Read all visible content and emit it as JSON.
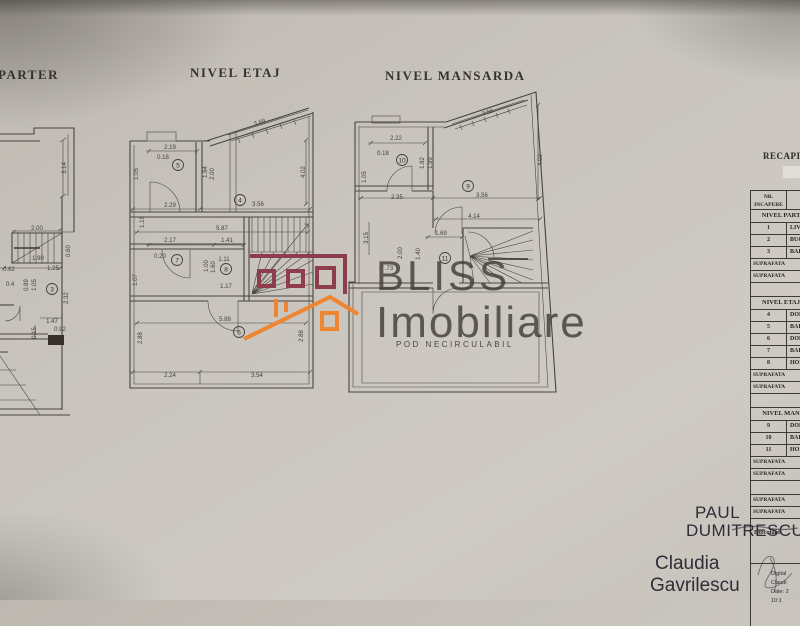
{
  "titles": {
    "parter": "PARTER",
    "etaj": "NIVEL ETAJ",
    "mansarda": "NIVEL MANSARDA"
  },
  "watermark": {
    "line1": "BLISS",
    "line2": "Imobiliare",
    "maroon_color": "#8e3d4d",
    "orange_color": "#ee8531"
  },
  "plans": {
    "parter": {
      "rooms": [
        {
          "n": "3",
          "x": 52,
          "y": 289
        }
      ],
      "dims": [
        {
          "t": "3.14",
          "x": 66,
          "y": 168,
          "r": -90
        },
        {
          "t": "2.00",
          "x": 37,
          "y": 230
        },
        {
          "t": "1.90",
          "x": 38,
          "y": 260
        },
        {
          "t": "0.60",
          "x": 70,
          "y": 251,
          "r": -90
        },
        {
          "t": "0.62",
          "x": 9,
          "y": 271
        },
        {
          "t": "1.25",
          "x": 53,
          "y": 270
        },
        {
          "t": "0.89",
          "x": 28,
          "y": 285,
          "r": -90
        },
        {
          "t": "1.05",
          "x": 36,
          "y": 285,
          "r": -90
        },
        {
          "t": "0.4",
          "x": 10,
          "y": 286
        },
        {
          "t": "2.32",
          "x": 68,
          "y": 298,
          "r": -90
        },
        {
          "t": "1.47",
          "x": 52,
          "y": 323
        },
        {
          "t": "0.92",
          "x": 60,
          "y": 331
        },
        {
          "t": "0.15",
          "x": 36,
          "y": 333,
          "r": -90
        }
      ]
    },
    "etaj": {
      "rooms": [
        {
          "n": "5",
          "x": 178,
          "y": 165
        },
        {
          "n": "4",
          "x": 240,
          "y": 200
        },
        {
          "n": "7",
          "x": 177,
          "y": 260
        },
        {
          "n": "8",
          "x": 226,
          "y": 269
        },
        {
          "n": "6",
          "x": 239,
          "y": 332
        }
      ],
      "dims": [
        {
          "t": "2.19",
          "x": 170,
          "y": 149
        },
        {
          "t": "0.18",
          "x": 163,
          "y": 159
        },
        {
          "t": "3.69",
          "x": 260,
          "y": 124,
          "r": -17
        },
        {
          "t": "4.02",
          "x": 305,
          "y": 172,
          "r": -90
        },
        {
          "t": "1.84",
          "x": 207,
          "y": 172,
          "r": -90
        },
        {
          "t": "2.00",
          "x": 214,
          "y": 174,
          "r": -90
        },
        {
          "t": "1.05",
          "x": 138,
          "y": 174,
          "r": -90
        },
        {
          "t": "2.29",
          "x": 170,
          "y": 207
        },
        {
          "t": "3.56",
          "x": 258,
          "y": 206
        },
        {
          "t": "5.87",
          "x": 222,
          "y": 230
        },
        {
          "t": "2.17",
          "x": 170,
          "y": 242
        },
        {
          "t": "1.41",
          "x": 227,
          "y": 242
        },
        {
          "t": "1.15",
          "x": 144,
          "y": 222,
          "r": -90
        },
        {
          "t": "0.20",
          "x": 160,
          "y": 258
        },
        {
          "t": "1.00",
          "x": 208,
          "y": 266,
          "r": -90
        },
        {
          "t": "1.60",
          "x": 215,
          "y": 267,
          "r": -90
        },
        {
          "t": "1.11",
          "x": 224,
          "y": 261
        },
        {
          "t": "1.17",
          "x": 226,
          "y": 288
        },
        {
          "t": "1.07",
          "x": 137,
          "y": 280,
          "r": -90
        },
        {
          "t": "5.88",
          "x": 225,
          "y": 321
        },
        {
          "t": "2.88",
          "x": 142,
          "y": 338,
          "r": -90
        },
        {
          "t": "2.88",
          "x": 303,
          "y": 336,
          "r": -90
        },
        {
          "t": "2.24",
          "x": 170,
          "y": 377
        },
        {
          "t": "3.54",
          "x": 257,
          "y": 377
        }
      ]
    },
    "mansarda": {
      "note": "POD NECIRCULABIL",
      "rooms": [
        {
          "n": "10",
          "x": 402,
          "y": 160
        },
        {
          "n": "9",
          "x": 468,
          "y": 186
        },
        {
          "n": "11",
          "x": 445,
          "y": 258
        }
      ],
      "dims": [
        {
          "t": "2.22",
          "x": 396,
          "y": 140
        },
        {
          "t": "0.18",
          "x": 383,
          "y": 155
        },
        {
          "t": "3.56",
          "x": 488,
          "y": 114,
          "r": -18
        },
        {
          "t": "4.02",
          "x": 542,
          "y": 160,
          "r": -90
        },
        {
          "t": "1.82",
          "x": 424,
          "y": 163,
          "r": -90
        },
        {
          "t": "1.99",
          "x": 432,
          "y": 163,
          "r": -90
        },
        {
          "t": "1.05",
          "x": 366,
          "y": 177,
          "r": -90
        },
        {
          "t": "2.35",
          "x": 397,
          "y": 199
        },
        {
          "t": "3.56",
          "x": 482,
          "y": 197
        },
        {
          "t": "4.14",
          "x": 474,
          "y": 218
        },
        {
          "t": "1.69",
          "x": 441,
          "y": 235
        },
        {
          "t": "3.15",
          "x": 368,
          "y": 238,
          "r": -90
        },
        {
          "t": "2.00",
          "x": 402,
          "y": 253,
          "r": -90
        },
        {
          "t": "1.40",
          "x": 420,
          "y": 254,
          "r": -90
        },
        {
          "t": ".73",
          "x": 389,
          "y": 270
        }
      ]
    }
  },
  "table": {
    "title": "RECAPITU",
    "col1_line1": "NR.",
    "col1_line2": "INCAPERE",
    "rows": [
      {
        "type": "section",
        "label": "NIVEL PART"
      },
      {
        "type": "room",
        "num": "1",
        "label": "LIV"
      },
      {
        "type": "room",
        "num": "2",
        "label": "BUC"
      },
      {
        "type": "room",
        "num": "3",
        "label": "BAI"
      },
      {
        "type": "suprafata",
        "label": "SUPRAFATA"
      },
      {
        "type": "suprafata",
        "label": "SUPRAFATA"
      },
      {
        "type": "spacer",
        "label": ""
      },
      {
        "type": "section",
        "label": "NIVEL ETAJ"
      },
      {
        "type": "room",
        "num": "4",
        "label": "DOR"
      },
      {
        "type": "room",
        "num": "5",
        "label": "BAI"
      },
      {
        "type": "room",
        "num": "6",
        "label": "DOR"
      },
      {
        "type": "room",
        "num": "7",
        "label": "BAI"
      },
      {
        "type": "room",
        "num": "8",
        "label": "HOL"
      },
      {
        "type": "suprafata",
        "label": "SUPRAFATA"
      },
      {
        "type": "suprafata",
        "label": "SUPRAFATA"
      },
      {
        "type": "spacer",
        "label": ""
      },
      {
        "type": "section",
        "label": "NIVEL MAN"
      },
      {
        "type": "room",
        "num": "9",
        "label": "DOR"
      },
      {
        "type": "room",
        "num": "10",
        "label": "BAI"
      },
      {
        "type": "room",
        "num": "11",
        "label": "HOL"
      },
      {
        "type": "suprafata",
        "label": "SUPRAFATA"
      },
      {
        "type": "suprafata",
        "label": "SUPRAFATA"
      },
      {
        "type": "spacer",
        "label": ""
      },
      {
        "type": "suprafata",
        "label": "SUPRAFATA"
      },
      {
        "type": "suprafata",
        "label": "SUPRAFATA"
      }
    ]
  },
  "signatures": {
    "executant_label": "Executant:",
    "name1_line1": "PAUL",
    "name1_line2": "DUMITRESCU",
    "name2_line1": "Claudia",
    "name2_line2": "Gavrilescu",
    "digital": [
      "Digital",
      "Claudi",
      "Date: 2",
      "10:1"
    ]
  }
}
